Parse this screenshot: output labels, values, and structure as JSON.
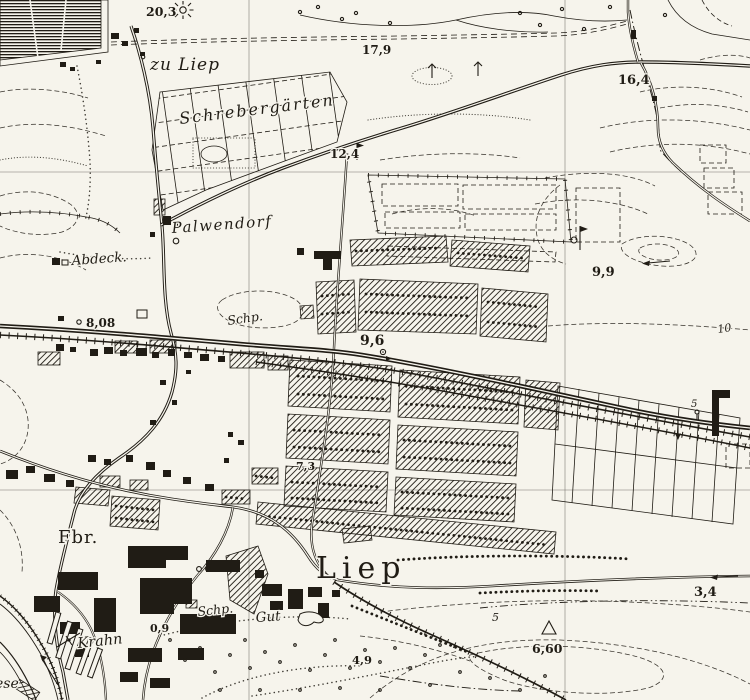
{
  "map": {
    "kind": "historical-topographic-map",
    "paper_color": "#f6f4ec",
    "ink_color": "#201c15"
  },
  "labels": {
    "zu_liep": "zu Liep",
    "schrebergaerten": "Schrebergärten",
    "palwendorf": "Palwendorf",
    "abdeck": "Abdeck.",
    "schp_upper": "Schp.",
    "fbr": "Fbr.",
    "liep": "Liep",
    "schp_lower": "Schp.",
    "gut": "Gut",
    "krahn": "Krahn",
    "meadow_partial": "ese"
  },
  "elevations": {
    "pt_20_3": "20,3",
    "pt_17_9": "17,9",
    "pt_16_4": "16,4",
    "pt_12_4": "12,4",
    "pt_9_9": "9,9",
    "pt_8_08": "8,08",
    "pt_9_6": "9,6",
    "pt_7_3": "7,3",
    "pt_0_9": "0,9",
    "pt_4_9": "4,9",
    "pt_6_60": "6,60",
    "pt_3_4": "3,4"
  },
  "contour_labels": {
    "c_10": "10",
    "c_5": "5",
    "c_5_small": "5"
  },
  "symbols": {
    "trig_point": "triangle",
    "windmill_pump": "flag-on-pole",
    "flow_arrow": "arrow",
    "rayed_pit": "rayed-circle",
    "crane": "cross-bar",
    "direction_arrow": "left-arrow"
  }
}
